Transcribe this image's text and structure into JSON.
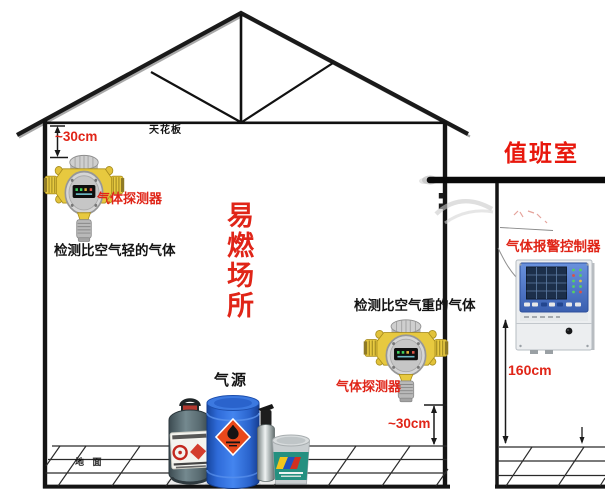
{
  "colors": {
    "accent_red": "#e02518",
    "duty_red": "#e8170c",
    "text_black": "#141414",
    "detector_yellow": "#e7c93f",
    "drum_blue": "#3f7ee8",
    "controller_blue": "#4a74c8"
  },
  "room": {
    "ceiling_label": "天花板",
    "flammable_area_label": "易燃场所",
    "ground_label": "地 面"
  },
  "detector_top": {
    "offset_label": "~30cm",
    "device_label": "气体探测器",
    "note": "检测比空气轻的气体"
  },
  "detector_bottom": {
    "offset_label": "~30cm",
    "device_label": "气体探测器",
    "note": "检测比空气重的气体"
  },
  "gas_source": {
    "label": "气源"
  },
  "duty_room": {
    "title": "值班室",
    "controller_label": "气体报警控制器",
    "mount_height_label": "160cm"
  }
}
